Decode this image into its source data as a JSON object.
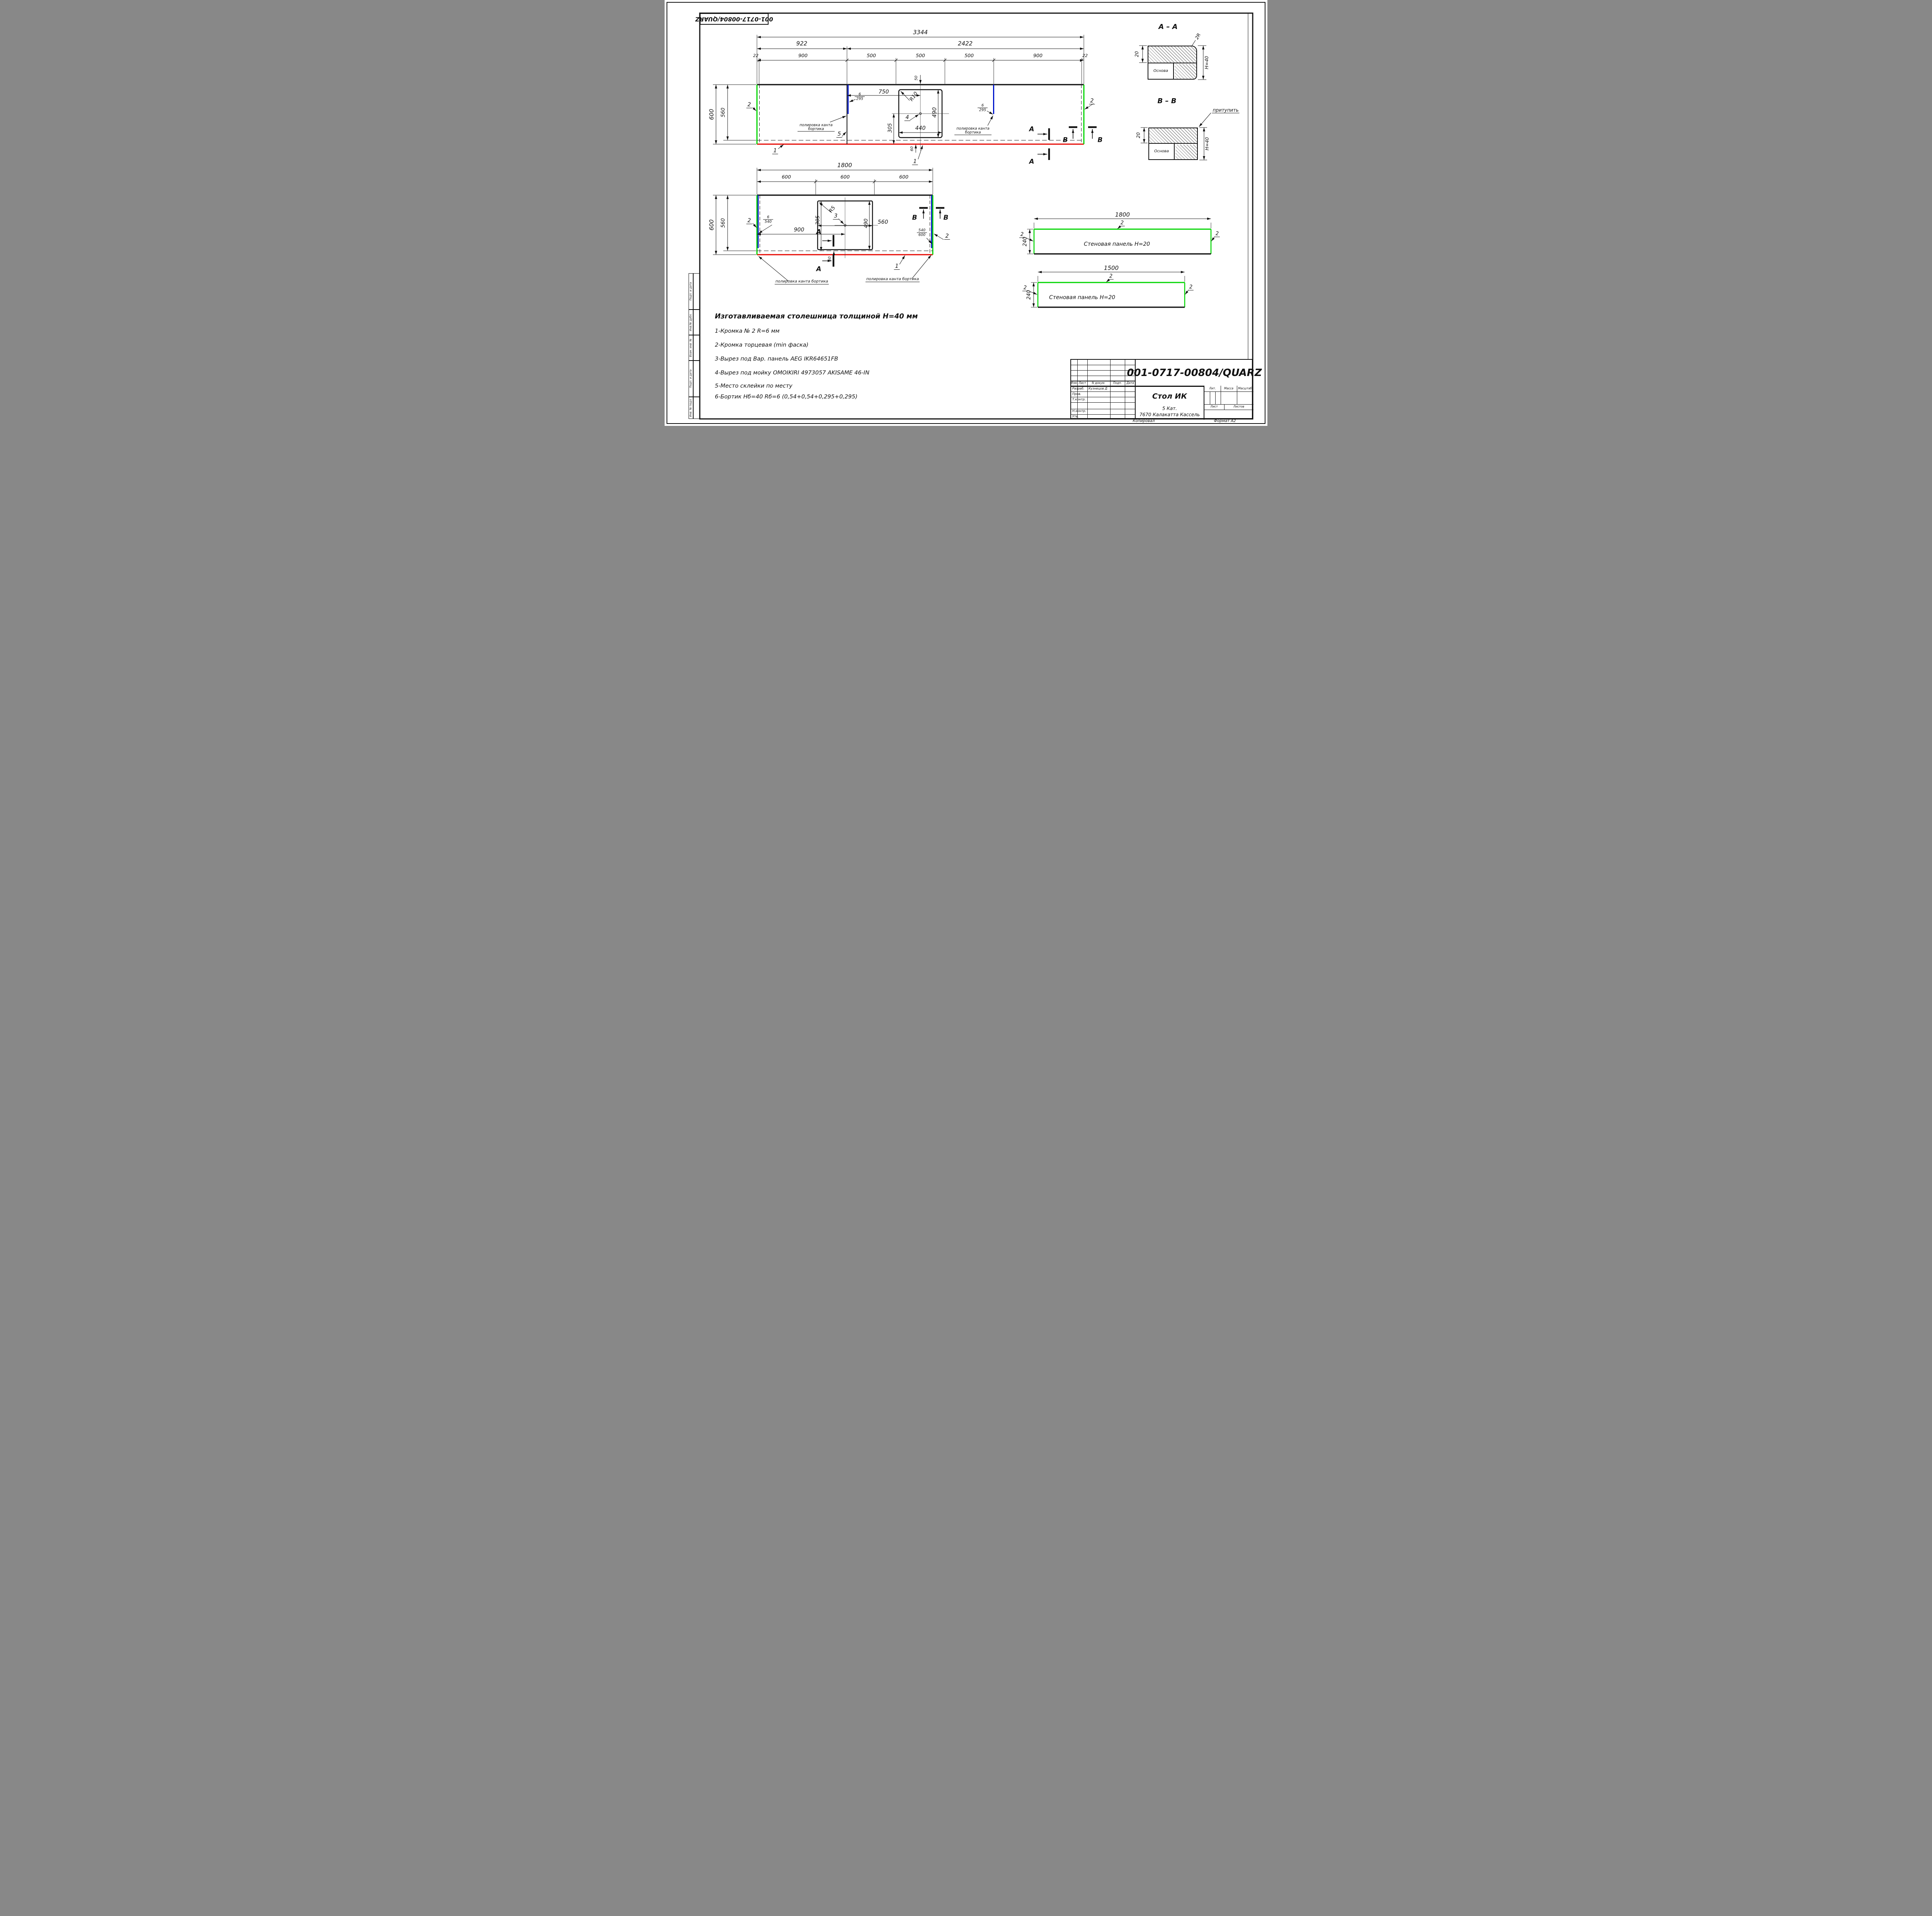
{
  "sheet": {
    "corner_stamp": "001-0717-00804/QUARZ",
    "copied": "Копировал",
    "format": "Формат А2"
  },
  "side_strip": {
    "c1": "Подп. и дата",
    "c2": "Инв.№ дубл.",
    "c3": "Взам. инв. №",
    "c4": "Подп. и дата",
    "c5": "Инв. № подл."
  },
  "sections": {
    "aa": "А – А",
    "bb": "В – В",
    "a": "А",
    "b": "В",
    "r2": "2R",
    "blunt": "притупить",
    "h40": "H=40",
    "t20": "20",
    "base": "Основа"
  },
  "dims": {
    "d3344": "3344",
    "d922": "922",
    "d2422": "2422",
    "d22": "22",
    "d900": "900",
    "d500": "500",
    "d600": "600",
    "d560": "560",
    "d750": "750",
    "d305": "305",
    "d50": "50",
    "d60": "60",
    "d490": "490",
    "d440": "440",
    "d1800": "1800",
    "d1500": "1500",
    "d240": "240",
    "r10": "R10",
    "r5": "R5"
  },
  "callouts": {
    "n6": "6",
    "n295": "295",
    "n540": "540",
    "n600": "600",
    "polish": "полировка канта бортика"
  },
  "balloons": {
    "n1": "1",
    "n2": "2",
    "n3": "3",
    "n4": "4",
    "n5": "5"
  },
  "panel": {
    "label": "Стеновая панель Н=20"
  },
  "notes": {
    "title": "Изготавливаемая столешница толщиной Н=40 мм",
    "i1": "1-Кромка № 2 R=6 мм",
    "i2": "2-Кромка торцевая (min фаска)",
    "i3": "3-Вырез под Вар. панель AEG IKR64651FB",
    "i4": "4-Вырез под мойку OMOIKIRI 4973057 AKISAME 46-IN",
    "i5": "5-Место склейки по месту",
    "i6": "6-Бортик Нб=40 Rб=6 (0,54+0,54+0,295+0,295)"
  },
  "title_block": {
    "doc": "001-0717-00804/QUARZ",
    "name": "Стол ИК",
    "mat1": "5 Кат.",
    "mat2": "7670 Калакатта Кассель",
    "izm": "Изм.",
    "list": "Лист",
    "ndoc": "N докум.",
    "podp": "Подп.",
    "date": "Дата",
    "razrab": "Разраб.",
    "razrab_v": "Кузнецов Д",
    "prov": "Пров.",
    "tkontr": "Т.контр.",
    "nkontr": "Н.контр.",
    "utv": "Утв.",
    "lit": "Лит.",
    "massa": "Масса",
    "scale": "Масштаб",
    "list2": "Лист",
    "listov": "Листов"
  }
}
